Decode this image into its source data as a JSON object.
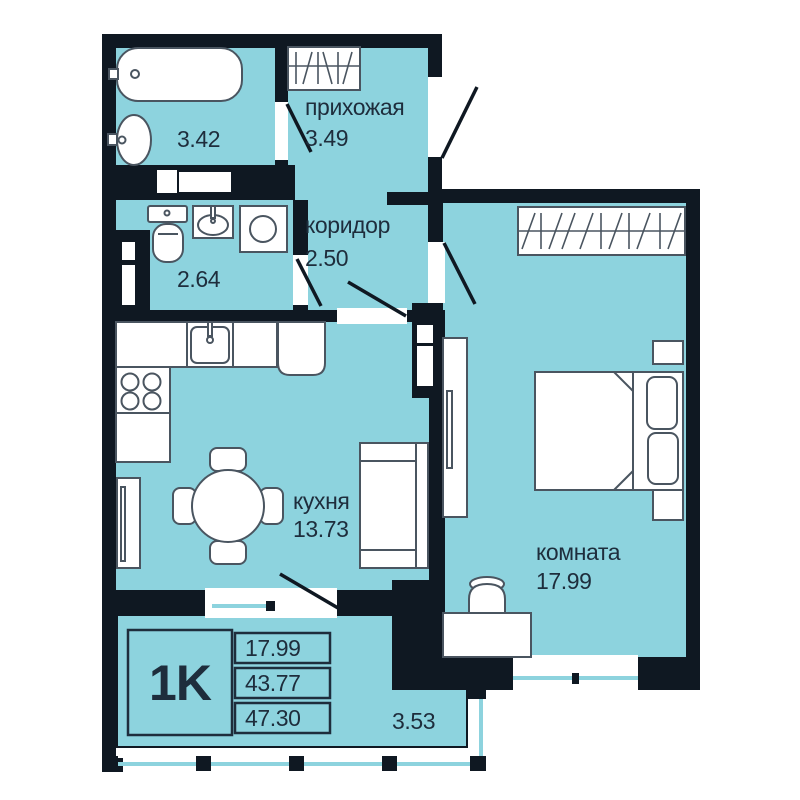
{
  "legend": {
    "type": "1K",
    "room_area": "17.99",
    "living_area": "43.77",
    "total_area": "47.30"
  },
  "rooms": {
    "hallway": {
      "label": "прихожая",
      "area": "3.49"
    },
    "bathroom": {
      "area": "3.42"
    },
    "toilet": {
      "area": "2.64"
    },
    "corridor": {
      "label": "коридор",
      "area": "2.50"
    },
    "kitchen": {
      "label": "кухня",
      "area": "13.73"
    },
    "room": {
      "label": "комната",
      "area": "17.99"
    },
    "balcony": {
      "area": "3.53"
    }
  },
  "colors": {
    "floor": "#8DD3DE",
    "wall": "#0F1822",
    "line": "#4A5560",
    "text": "#1E2D3C"
  }
}
